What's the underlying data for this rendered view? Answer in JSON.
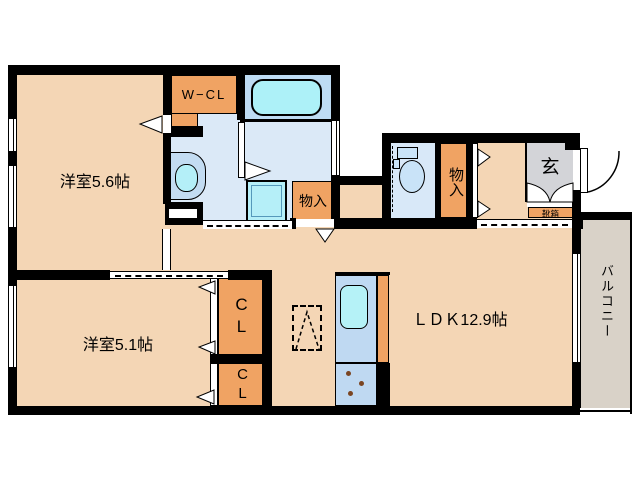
{
  "plan": {
    "bedroom1": {
      "label": "洋室5.6帖"
    },
    "bedroom2": {
      "label": "洋室5.1帖"
    },
    "ldk": {
      "label": "ＬＤＫ12.9帖"
    },
    "walk_in_closet": {
      "label": "W−CL"
    },
    "storage_hall": {
      "label": "物入"
    },
    "storage_washroom": {
      "label": "物入"
    },
    "entrance": {
      "label": "玄"
    },
    "shoe_box": {
      "label": "靴箱"
    },
    "closet_upper": {
      "label": "CL"
    },
    "closet_lower": {
      "label": "CL"
    },
    "balcony": {
      "label": "バルコニー"
    }
  },
  "colors": {
    "floor": "#F4D6B5",
    "closet_orange": "#F0A363",
    "bathroom": "#BEDCF4",
    "bathtub": "#ADF1F8",
    "washroom": "#DBE9F7",
    "toilet_room": "#D8E8F8",
    "fixture_blue": "#C9E3F8",
    "kitchen_unit": "#BFD9F2",
    "kitchen_sink": "#B5F2F7",
    "entrance_gray": "#D3D4D8",
    "balcony_gray": "#D9D2C8",
    "wall": "#000000"
  }
}
